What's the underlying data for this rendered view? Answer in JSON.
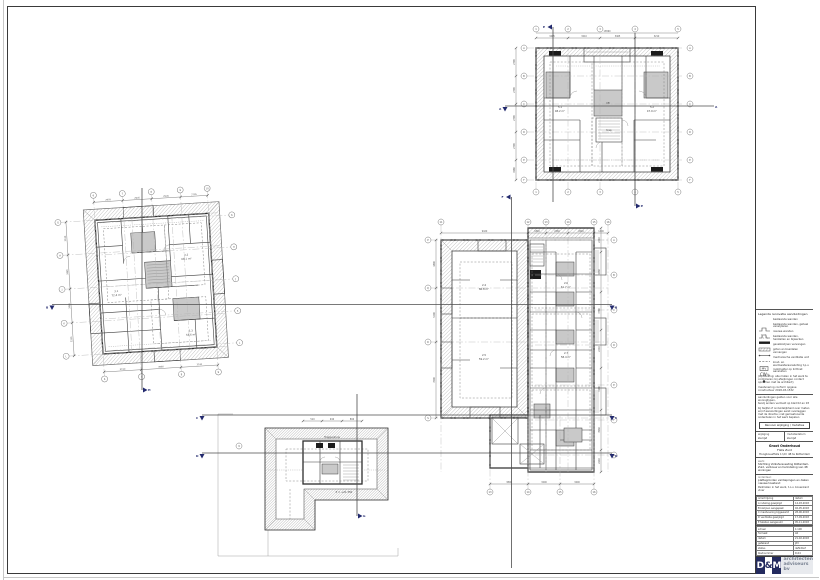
{
  "sheet": {
    "type": "architectural-drawing",
    "background": "#ffffff"
  },
  "colors": {
    "navy_accent": "#232a6e",
    "line_dark": "#2d2d2d",
    "line_grey": "#8a8a8a",
    "room_fill": "#c9c9c9",
    "logo_navy": "#232a5e",
    "logo_grey_text": "#7b8494"
  },
  "legend": {
    "title": "Legenda renovatie aanduidingen",
    "items": [
      {
        "icon": "wall-existing-icon",
        "label": "bestaande wanden"
      },
      {
        "icon": "wall-remove-icon",
        "label": "bestaande wanden, geheel verwijderen"
      },
      {
        "icon": "wall-new-icon",
        "label": "nieuwe wanden"
      },
      {
        "icon": "wall-repair-icon",
        "label": "bestaande wanden, herstellen en bijwerken"
      },
      {
        "icon": "line-solid-icon",
        "label": "gevelkozijnen vervangen"
      },
      {
        "icon": "line-dash-icon",
        "label": "goten en boeidelen vervangen"
      },
      {
        "icon": "mv-box-icon",
        "glyph": "MV",
        "label": "mechanische ventilatie unit"
      },
      {
        "icon": "cv-icon",
        "glyph": "CW",
        "label": "koud- en warmwateraansluiting t.p.v."
      },
      {
        "icon": "dot-icon",
        "label": "rookmelder op lichtnet aansluiten"
      }
    ],
    "note1": "(Opmerking: alle maten in het werk te controleren; bij afwijkingen contact opnemen met de architect)",
    "note2": "maatvoering conform opgave constructeur 2018-03-1532"
  },
  "stamp": {
    "note_a": "aanduidingen gelden voor alle woningtypen,",
    "note_b": "tenzij anders vermeld op blad 02 en 03",
    "note_block": "bij twijfel of onduidelijkheid over maten en/of aansluitingen eerst overleggen met de directie; niet gemaatvoerde onderdelen in het werk bepalen",
    "revision_box": "Renvooi wijziging / mutaties",
    "col1_label": "wijziging",
    "col1_value": "zie lijst",
    "col2_label": "mutatiedatum",
    "col2_value": "zie lijst",
    "project_title": "Groot Onderhoud",
    "project_name": "Flats Zuid",
    "project_sub": "Hoogbouwflats 1 t/m 48 te Rotterdam",
    "client_label": "werk:",
    "client": "Stichting Volkshuisvesting Rotterdam-Zuid, verbouw en herindeling van 48 woningen",
    "subject_label": "onderdeel:",
    "subject1": "plattegronden verdiepingen en daken",
    "subject2": "nieuwe toestand",
    "note3": "Peilmaten in het werk, t.o.v. bovenkant vloer",
    "rev_header_l": "omschrijving",
    "rev_header_r": "datum",
    "revisions": [
      {
        "text": "A  indeling gewijzigd",
        "date": "14-03-2018"
      },
      {
        "text": "B  kozijnen aangepast",
        "date": "02-05-2018"
      },
      {
        "text": "C  maatvoering bijgewerkt",
        "date": "28-06-2018"
      },
      {
        "text": "D  ventilatie gewijzigd",
        "date": "17-09-2018"
      },
      {
        "text": "E  teksten aangevuld",
        "date": "05-11-2018"
      }
    ],
    "meta": [
      {
        "label": "schaal",
        "value": "1:100"
      },
      {
        "label": "formaat",
        "value": "A0"
      },
      {
        "label": "datum",
        "value": "21-02-2018"
      },
      {
        "label": "getekend",
        "value": "JdV"
      },
      {
        "label": "status",
        "value": "definitief"
      },
      {
        "label": "bladnummer",
        "value": "D-04"
      }
    ]
  },
  "logo": {
    "d": "D",
    "amp": "&",
    "m": "M",
    "line1": "architecten",
    "line2": "adviseurs bv"
  },
  "section_marks": {
    "aa": "A",
    "bb": "B",
    "cc": "C",
    "dd": "D",
    "ee": "E",
    "ff": "F",
    "gg": "G",
    "hh": "H"
  },
  "plans": [
    {
      "name": "verdieping toren",
      "grid_side": [
        "A",
        "B",
        "C",
        "D",
        "E",
        "F"
      ],
      "grid_main": [
        "1",
        "2",
        "3",
        "4",
        "5"
      ],
      "dims_top": [
        "3465",
        "3210",
        "3465",
        "3210"
      ],
      "dim_total": "13860",
      "dims_left": [
        "2790",
        "2790",
        "2790",
        "2790",
        "1980"
      ],
      "labels": [
        "5.1",
        "48.2 m²",
        "5.2",
        "47.9 m²",
        "lift",
        "trap"
      ]
    },
    {
      "name": "verdieping blok west",
      "grid_top": [
        "6",
        "7",
        "8",
        "9",
        "10"
      ],
      "grid_side": [
        "G",
        "H",
        "J",
        "K",
        "L"
      ],
      "dims_top": [
        "2905",
        "2905",
        "2905",
        "2705"
      ],
      "dims_left": [
        "3330",
        "3465",
        "3465",
        "3330"
      ],
      "dims_bottom": [
        "3740",
        "3980",
        "3740"
      ],
      "labels": [
        "3.1",
        "72.4 m²",
        "3.2",
        "68.1 m²",
        "3.3",
        "54.6 m²"
      ]
    },
    {
      "name": "verdieping blok midden",
      "grid_top": [
        "11",
        "12",
        "13",
        "14",
        "15",
        "16"
      ],
      "grid_right": [
        "A",
        "B",
        "C",
        "D",
        "E",
        "F",
        "G"
      ],
      "grid_left": [
        "P",
        "Q",
        "R",
        "S"
      ],
      "grid_bottom": [
        "13",
        "14",
        "15",
        "16"
      ],
      "dims_top": [
        "9420",
        "1840",
        "2260",
        "2640",
        "1400"
      ],
      "dims_right": [
        "2410",
        "4060",
        "3780",
        "2410",
        "4180",
        "3960",
        "2210"
      ],
      "dims_left": [
        "4800",
        "5400",
        "7600"
      ],
      "dims_bottom": [
        "3800",
        "3200",
        "3400"
      ],
      "labels": [
        "2.4",
        "86.8 m²",
        "2.5",
        "59.2 m²",
        "2.6",
        "61.7 m²",
        "2.7",
        "58.4 m²"
      ]
    },
    {
      "name": "dakaanzicht",
      "grid": [
        "9"
      ],
      "dims_top": [
        "510",
        "940",
        "890"
      ],
      "labels": [
        "Trappenhuis",
        "P = +21.350"
      ]
    }
  ]
}
